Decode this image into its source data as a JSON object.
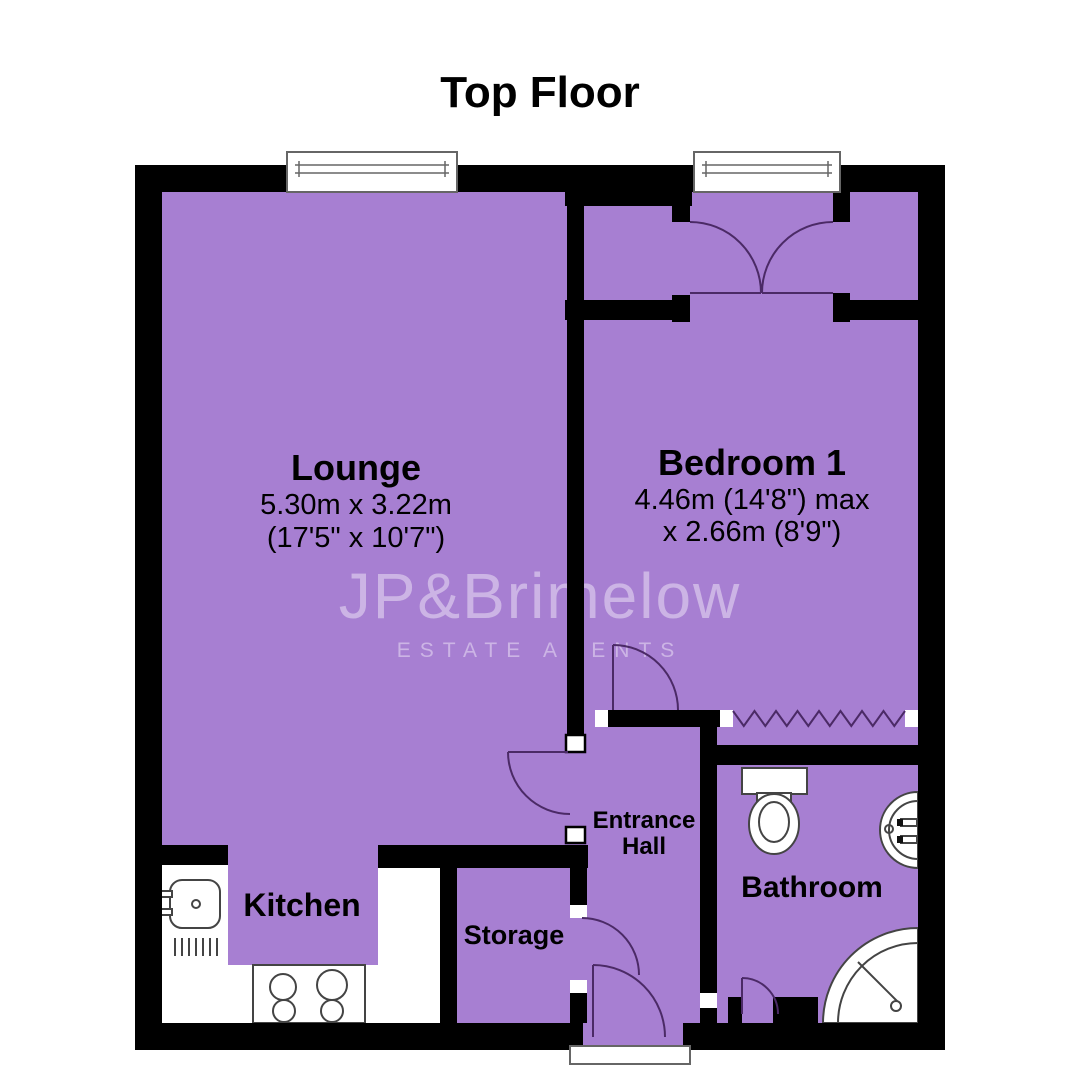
{
  "title": "Top Floor",
  "watermark": {
    "name": "JP&Brimelow",
    "tagline": "ESTATE AGENTS"
  },
  "rooms": {
    "lounge": {
      "name": "Lounge",
      "dim1": "5.30m x 3.22m",
      "dim2": "(17'5\" x 10'7\")"
    },
    "bedroom": {
      "name": "Bedroom 1",
      "dim1": "4.46m (14'8\") max",
      "dim2": "x 2.66m (8'9\")"
    },
    "kitchen": {
      "name": "Kitchen"
    },
    "hall": {
      "line1": "Entrance",
      "line2": "Hall"
    },
    "storage": {
      "name": "Storage"
    },
    "bathroom": {
      "name": "Bathroom"
    }
  },
  "colors": {
    "floor": "#a77fd2",
    "wall": "#000000",
    "door_arc": "#4b2a66",
    "fixture_stroke": "#444444",
    "outline": "#666666",
    "text": "#000000",
    "watermark": "rgba(255,255,255,0.42)",
    "background": "#ffffff"
  }
}
